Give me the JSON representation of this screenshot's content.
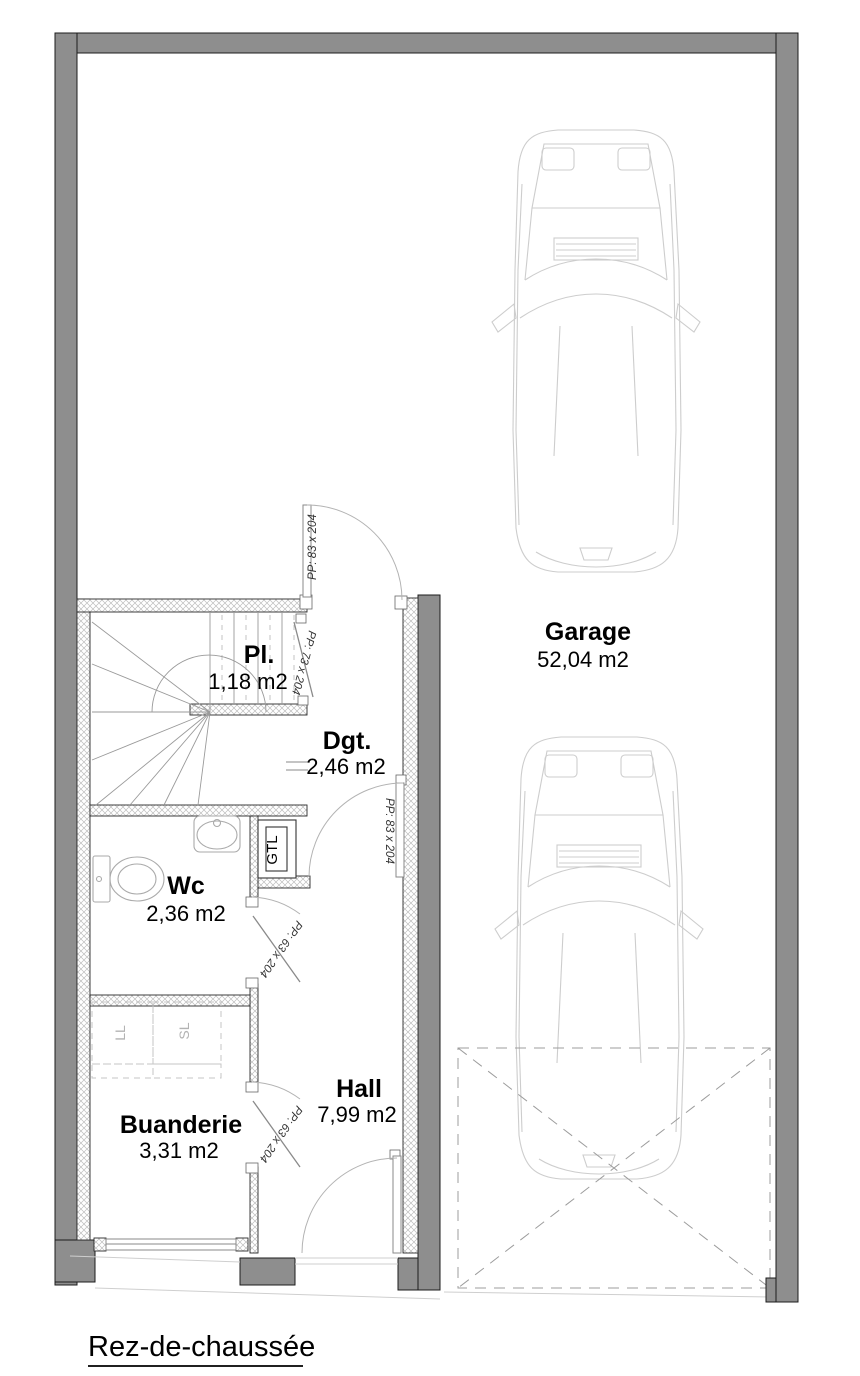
{
  "plan_title": "Rez-de-chaussée",
  "rooms": [
    {
      "name": "Pl.",
      "area": "1,18 m2"
    },
    {
      "name": "Dgt.",
      "area": "2,46 m2"
    },
    {
      "name": "Wc",
      "area": "2,36 m2"
    },
    {
      "name": "Buanderie",
      "area": "3,31 m2"
    },
    {
      "name": "Hall",
      "area": "7,99 m2"
    },
    {
      "name": "Garage",
      "area": "52,04 m2"
    }
  ],
  "doors": {
    "closet_door": "PP: 73 x 204",
    "garage_entry_door": "PP: 83 x 204",
    "dgt_hall_door": "PP: 83 x 204",
    "wc_door": "PP: 63 x 204",
    "laundry_door": "PP: 63 x 204"
  },
  "fixtures": {
    "electrical_panel": "GTL",
    "washing_machine": "LL",
    "dryer": "SL"
  },
  "colors": {
    "wall": "#8e8e8e",
    "hatch_line": "#bdbdbd",
    "car_outline": "#cdcdcd",
    "dash_line": "#9c9c9c",
    "fixture_line": "#aaaaaa",
    "text": "#000000"
  }
}
